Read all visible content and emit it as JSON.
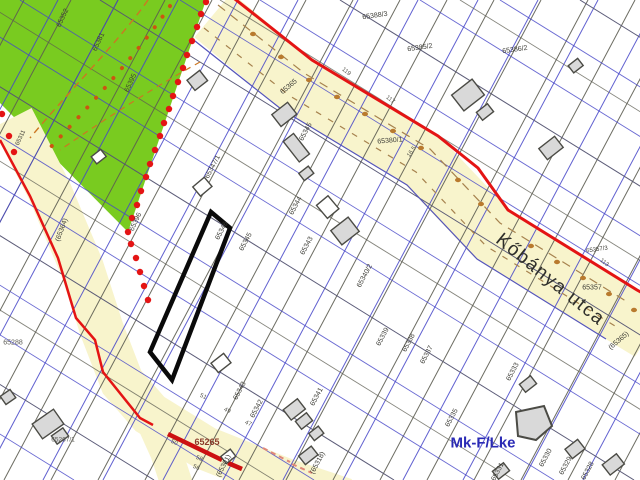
{
  "map": {
    "street_name": "Kőbánya utca",
    "zone_code": "Mk-F/Lke",
    "colors": {
      "green_zone": "#79cb20",
      "road_fill": "#f8f4cc",
      "boundary_red": "#e41414",
      "cadastral_blue": "#4646c8",
      "parcel_line": "#5d5d52",
      "orange_dash": "#cc7722",
      "highlight_outline": "#0a0a0a",
      "zone_text_blue": "#2a2ab5",
      "parcel_label_dark_red": "#8b3a2a",
      "building_fill": "#d9d9d9"
    },
    "highlighted_parcel": {
      "label": "65346"
    },
    "parcel_labels": [
      {
        "t": "65352",
        "x": 63,
        "y": 18,
        "r": -65
      },
      {
        "t": "65381",
        "x": 99,
        "y": 42,
        "r": -65
      },
      {
        "t": "65395",
        "x": 131,
        "y": 83,
        "r": -65
      },
      {
        "t": "65396",
        "x": 136,
        "y": 222,
        "r": -65
      },
      {
        "t": "65311",
        "x": 21,
        "y": 138,
        "r": -65,
        "s": 6
      },
      {
        "t": "65388/3",
        "x": 375,
        "y": 16,
        "r": -8
      },
      {
        "t": "65385/2",
        "x": 420,
        "y": 48,
        "r": -8
      },
      {
        "t": "65386/2",
        "x": 515,
        "y": 50,
        "r": -8
      },
      {
        "t": "65380/1",
        "x": 390,
        "y": 141,
        "r": -5
      },
      {
        "t": "65357/3",
        "x": 597,
        "y": 250,
        "r": -8,
        "s": 6
      },
      {
        "t": "65357",
        "x": 592,
        "y": 288,
        "r": 0
      },
      {
        "t": "(65365)",
        "x": 619,
        "y": 341,
        "r": -40
      },
      {
        "t": "65365",
        "x": 289,
        "y": 87,
        "r": -40
      },
      {
        "t": "(65364)",
        "x": 62,
        "y": 230,
        "r": -70
      },
      {
        "t": "65347/1",
        "x": 213,
        "y": 167,
        "r": -62
      },
      {
        "t": "65346",
        "x": 222,
        "y": 231,
        "r": -62
      },
      {
        "t": "65345",
        "x": 246,
        "y": 242,
        "r": -62
      },
      {
        "t": "65345",
        "x": 306,
        "y": 132,
        "r": -62
      },
      {
        "t": "65344",
        "x": 296,
        "y": 206,
        "r": -62
      },
      {
        "t": "65343",
        "x": 307,
        "y": 246,
        "r": -62
      },
      {
        "t": "65343",
        "x": 240,
        "y": 391,
        "r": -62
      },
      {
        "t": "65342",
        "x": 257,
        "y": 409,
        "r": -62
      },
      {
        "t": "65341",
        "x": 317,
        "y": 397,
        "r": -62
      },
      {
        "t": "65340/2",
        "x": 365,
        "y": 276,
        "r": -62
      },
      {
        "t": "65339",
        "x": 383,
        "y": 337,
        "r": -62
      },
      {
        "t": "65338",
        "x": 409,
        "y": 343,
        "r": -62
      },
      {
        "t": "65337",
        "x": 427,
        "y": 355,
        "r": -62
      },
      {
        "t": "65335",
        "x": 452,
        "y": 418,
        "r": -62
      },
      {
        "t": "65333",
        "x": 513,
        "y": 372,
        "r": -62
      },
      {
        "t": "65331",
        "x": 498,
        "y": 472,
        "r": -62
      },
      {
        "t": "65330",
        "x": 546,
        "y": 458,
        "r": -62
      },
      {
        "t": "65329",
        "x": 566,
        "y": 466,
        "r": -62
      },
      {
        "t": "65328",
        "x": 588,
        "y": 471,
        "r": -62
      },
      {
        "t": "(65301)",
        "x": 224,
        "y": 466,
        "r": -62
      },
      {
        "t": "(65318)",
        "x": 318,
        "y": 463,
        "r": -62
      },
      {
        "t": "65265",
        "x": 207,
        "y": 442,
        "r": 0,
        "s": 9,
        "c": "red"
      },
      {
        "t": "65288",
        "x": 13,
        "y": 343,
        "r": 0,
        "s": 7,
        "c": "gray"
      },
      {
        "t": "65267/1",
        "x": 63,
        "y": 440,
        "r": 0,
        "s": 6.5,
        "c": "gray"
      }
    ],
    "house_numbers": [
      {
        "t": "119",
        "x": 346,
        "y": 72,
        "r": 38
      },
      {
        "t": "117",
        "x": 390,
        "y": 100,
        "r": 38
      },
      {
        "t": "113",
        "x": 604,
        "y": 263,
        "r": 38
      },
      {
        "t": "16.5",
        "x": 412,
        "y": 152,
        "r": -55
      },
      {
        "t": "51",
        "x": 203,
        "y": 397,
        "r": 25
      },
      {
        "t": "49",
        "x": 227,
        "y": 411,
        "r": 25
      },
      {
        "t": "47",
        "x": 248,
        "y": 424,
        "r": 25
      },
      {
        "t": "50",
        "x": 174,
        "y": 443,
        "r": 25
      },
      {
        "t": "58",
        "x": 199,
        "y": 459,
        "r": 25
      },
      {
        "t": "56",
        "x": 196,
        "y": 468,
        "r": 25
      }
    ]
  }
}
